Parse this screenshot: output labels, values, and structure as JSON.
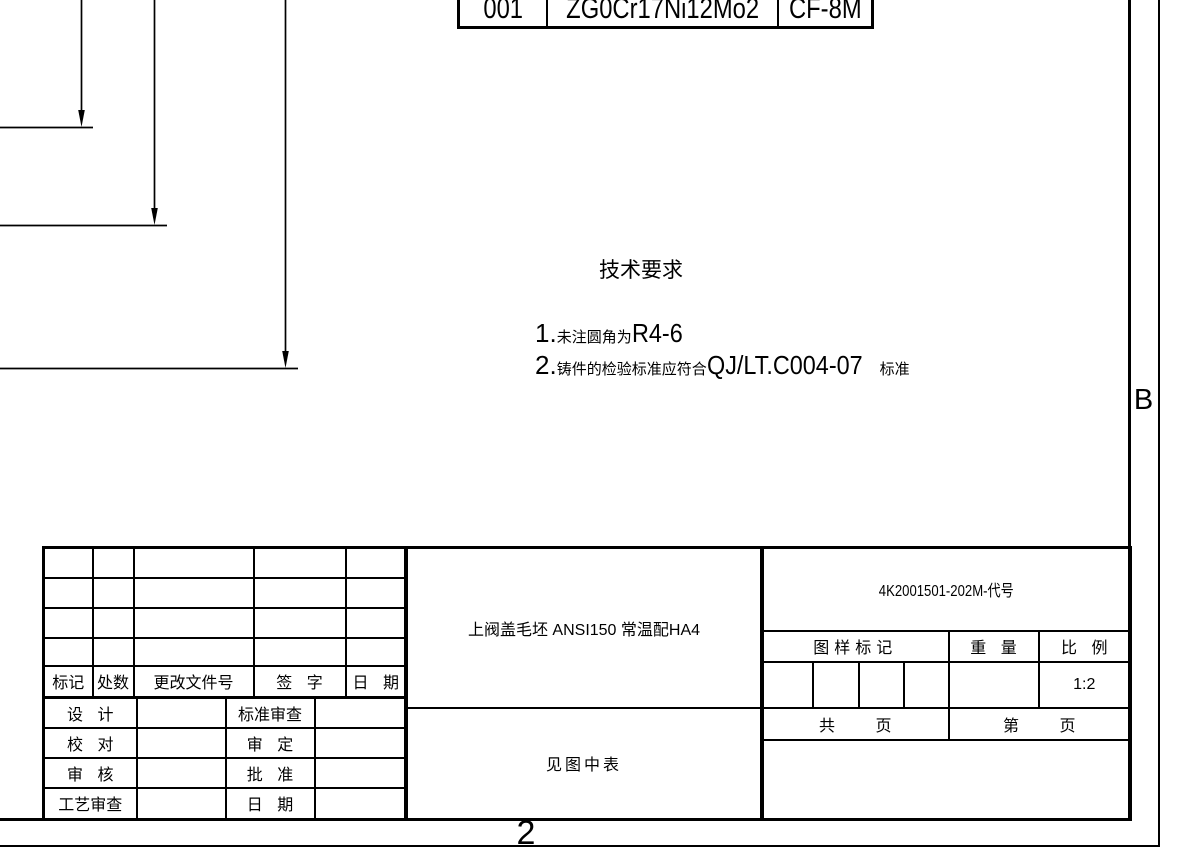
{
  "material_table": {
    "cells": [
      "001",
      "ZG0Cr17Ni12Mo2",
      "CF-8M"
    ]
  },
  "zone_markers": {
    "right_label": "B",
    "bottom_label": "2"
  },
  "technical_requirements": {
    "title": "技术要求",
    "items": [
      {
        "num": "1.",
        "pre": "未注圆角为",
        "code": "R4-6",
        "post": ""
      },
      {
        "num": "2.",
        "pre": "铸件的检验标准应符合",
        "code": "QJ/LT.C004-07",
        "post": "标准"
      }
    ]
  },
  "title_block": {
    "revision_headers": [
      "标记",
      "处数",
      "更改文件号",
      "签 字",
      "日 期"
    ],
    "signature_rows": [
      {
        "left_label": "设 计",
        "left_value": "",
        "right_label": "标准审查",
        "right_value": ""
      },
      {
        "left_label": "校 对",
        "left_value": "",
        "right_label": "审 定",
        "right_value": ""
      },
      {
        "left_label": "审 核",
        "left_value": "",
        "right_label": "批 准",
        "right_value": ""
      },
      {
        "left_label": "工艺审查",
        "left_value": "",
        "right_label": "日 期",
        "right_value": ""
      }
    ],
    "part_title": "上阀盖毛坯 ANSI150  常温配HA4",
    "material_note": "见图中表",
    "drawing_number": "4K2001501-202M-代号",
    "stamp_label": "图样标记",
    "weight_label": "重 量",
    "scale_label": "比 例",
    "scale_value": "1:2",
    "total_pages_label": "共 页",
    "page_label": "第 页"
  },
  "colors": {
    "line": "#000000",
    "background": "#ffffff"
  }
}
